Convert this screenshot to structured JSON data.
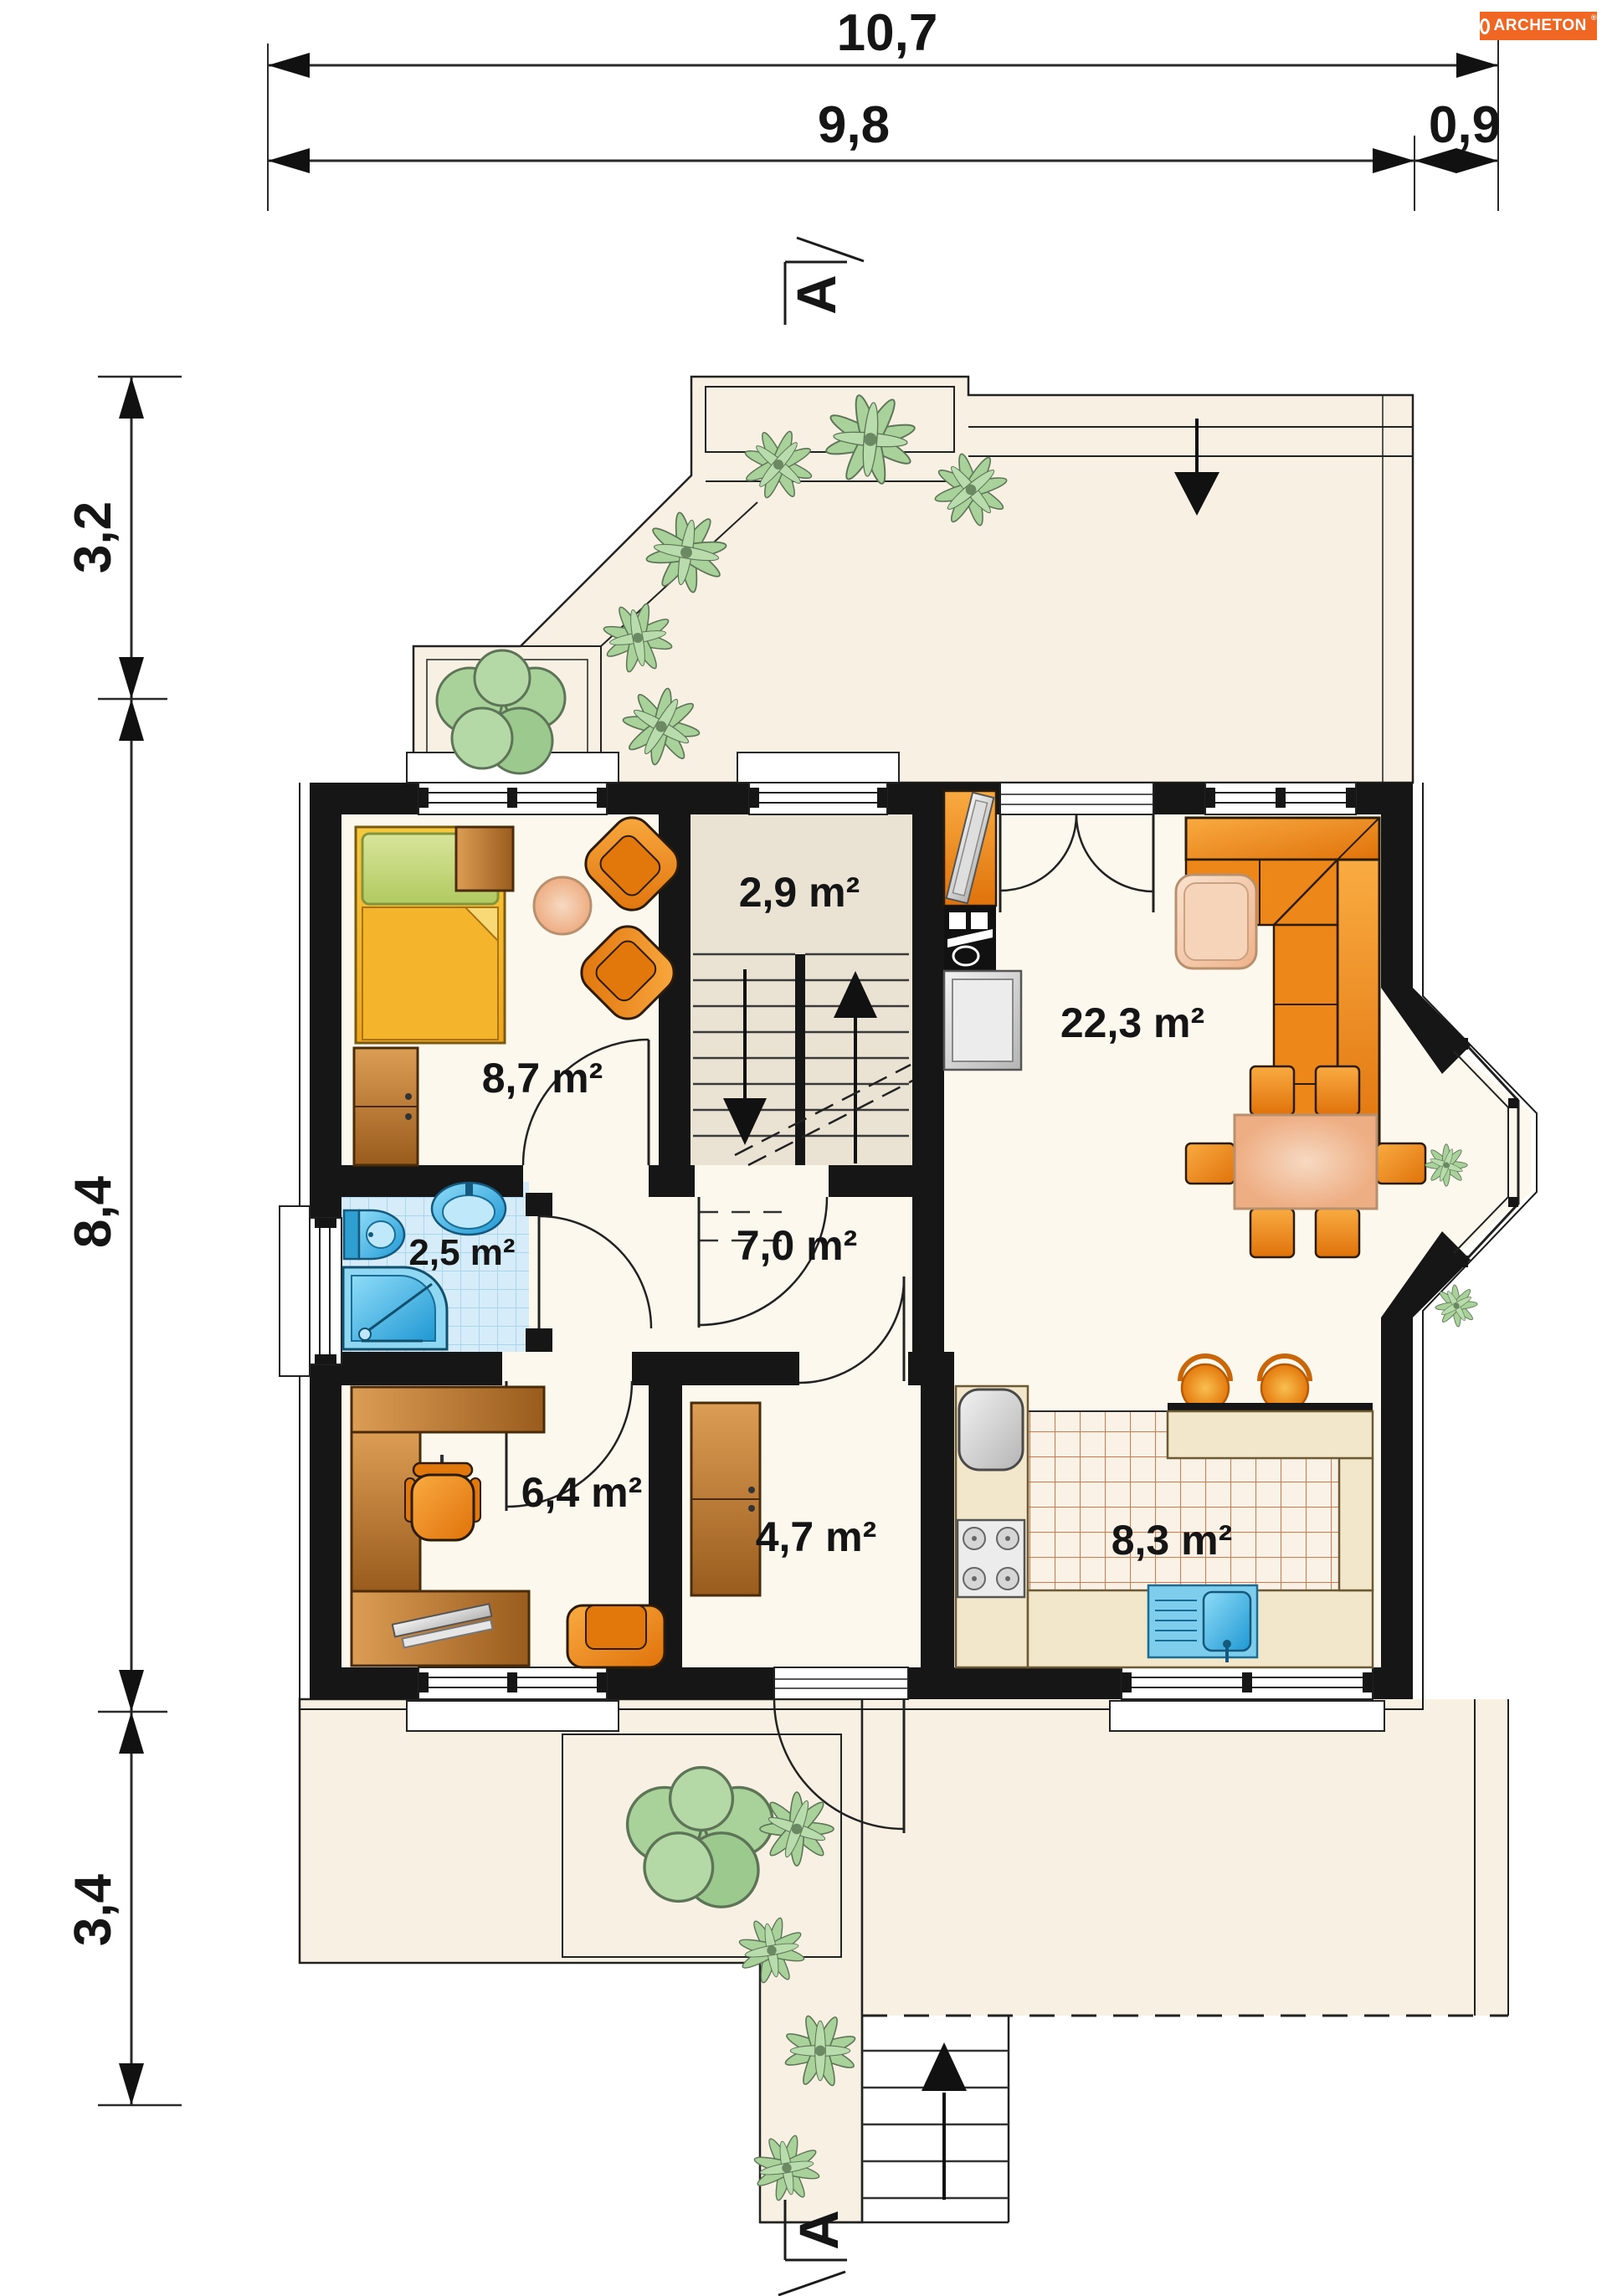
{
  "brand": {
    "name": "ARCHETON",
    "registered": "®",
    "bg_color": "#f06623"
  },
  "dimensions_top": [
    {
      "value": "10,7"
    },
    {
      "value": "9,8"
    },
    {
      "value": "0,9"
    }
  ],
  "dimensions_left": [
    {
      "value": "3,2"
    },
    {
      "value": "8,4"
    },
    {
      "value": "3,4"
    }
  ],
  "section_marker": {
    "top": "A",
    "bottom": "A"
  },
  "rooms": [
    {
      "name": "staircase",
      "area": "2,9 m²"
    },
    {
      "name": "bedroom",
      "area": "8,7 m²"
    },
    {
      "name": "living-room",
      "area": "22,3 m²"
    },
    {
      "name": "bathroom",
      "area": "2,5 m²"
    },
    {
      "name": "hall",
      "area": "7,0 m²"
    },
    {
      "name": "study",
      "area": "6,4 m²"
    },
    {
      "name": "closet",
      "area": "4,7 m²"
    },
    {
      "name": "kitchen",
      "area": "8,3 m²"
    }
  ],
  "colors": {
    "wall": "#161616",
    "floor": "#fdf8ee",
    "terrace": "#f8f1e3",
    "stair_floor": "#eae3d3",
    "bath_tile": "#d7ecf9",
    "bath_tile_line": "#a9d6ef",
    "kitchen_tile_line": "#d4784a",
    "furniture_orange": "#ee8719",
    "wood_brown": "#b5742f",
    "water_blue": "#2e9fd0",
    "plant_green": "#a8d29a",
    "brand_orange": "#f06623"
  }
}
